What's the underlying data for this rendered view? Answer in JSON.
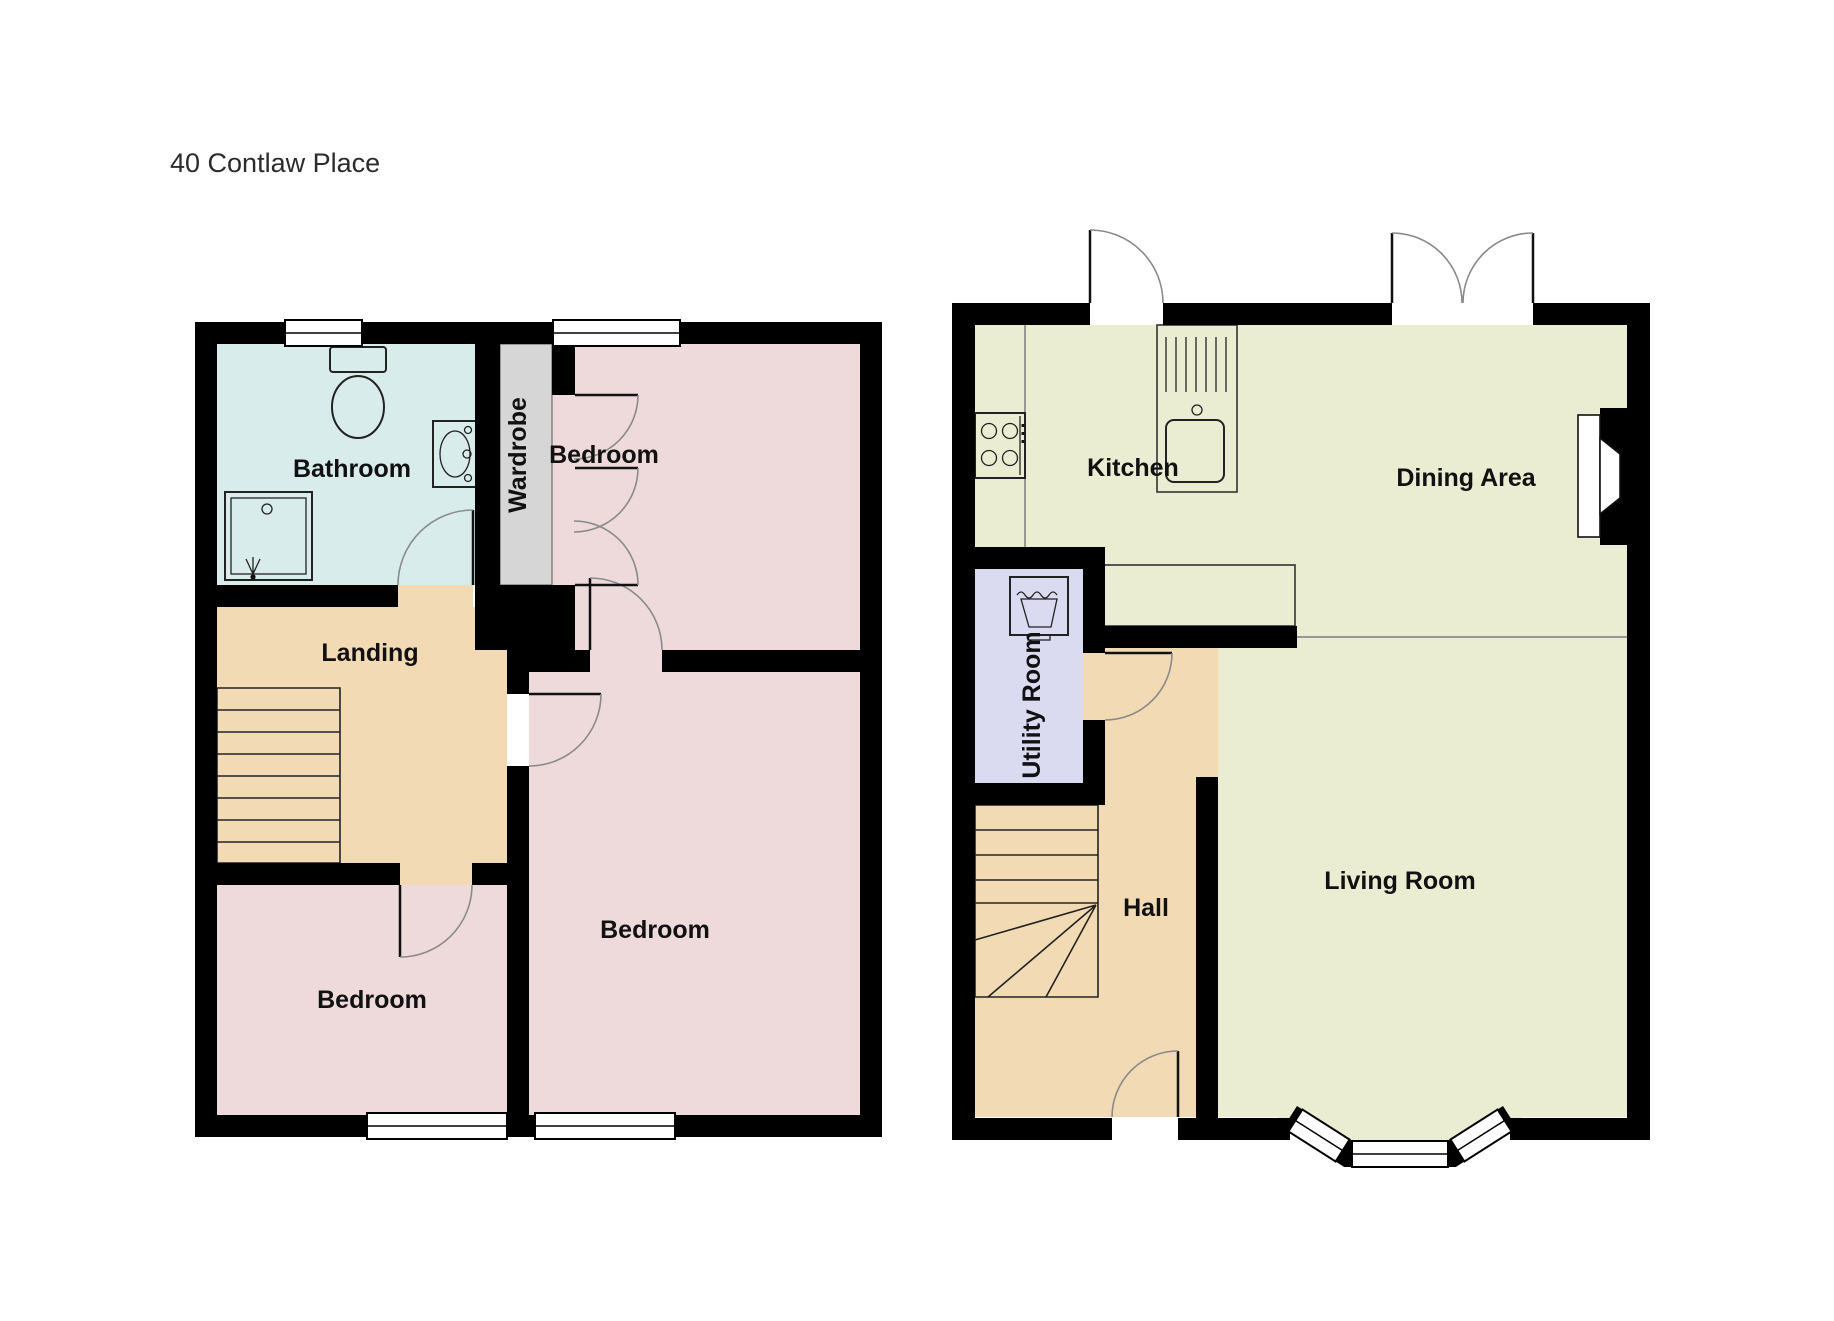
{
  "title": "40 Contlaw Place",
  "floors": {
    "upper": {
      "rooms": {
        "bathroom": "Bathroom",
        "wardrobe": "Wardrobe",
        "bedroom_top": "Bedroom",
        "landing": "Landing",
        "bedroom_right": "Bedroom",
        "bedroom_bottom": "Bedroom"
      }
    },
    "ground": {
      "rooms": {
        "kitchen": "Kitchen",
        "dining": "Dining Area",
        "utility": "Utility Room",
        "hall": "Hall",
        "living": "Living Room"
      }
    }
  },
  "colors": {
    "wall": "#000000",
    "bathroom": "#d8ecec",
    "wardrobe": "#d6d6d6",
    "bedroom": "#eedadb",
    "landing": "#f2dbb4",
    "kitchen_living": "#ebedd3",
    "utility": "#dadaf0",
    "door_arc": "#8a8a8a"
  }
}
